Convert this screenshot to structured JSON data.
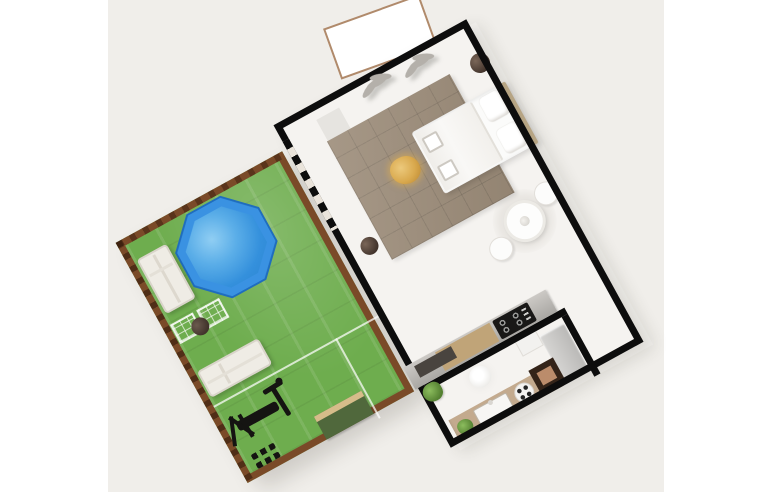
{
  "palette": {
    "background_scene": "#f0eeea",
    "floor": "#f5f3f0",
    "wall": "#0d0d0d",
    "grass": "#6ead4e",
    "fence": "#7a4a28",
    "pool_rim": "#3a92e2",
    "pool_water": "#3490dc",
    "rug": "#9c8c79",
    "bed_white": "#fbfbfa",
    "headboard": "#c6b28f",
    "lounger": "#efece5",
    "terrace_border": "#b08a6b",
    "counter_wood": "#c0a478",
    "cooktop": "#191817",
    "sink_counter": "#c3aa8e",
    "cabinet_dark": "#342419",
    "cabinet_board": "#bb8c6b",
    "fridge": "#bab9b7",
    "pot": "#41332b",
    "plant": "#548031",
    "decor_gray": "#b4b0aa",
    "gym_black": "#151412",
    "garden_bed_green": "#50683c",
    "garden_bed_trim": "#d6bc8a"
  },
  "scene": {
    "view": "top-down floor plan render, rotated about -29 degrees",
    "garden": {
      "items": [
        "octagonal-pool",
        "sun-lounger",
        "sun-lounger",
        "planter-rack",
        "planter-rack",
        "round-pot",
        "garden-bed",
        "gym-machine",
        "dumbbell-rack",
        "white-divider-lines",
        "wood-fence-border"
      ]
    },
    "main_room": {
      "items": [
        "double-bed-with-pillows",
        "tiled-area-rug",
        "golden-pouf",
        "round-dining-table",
        "chair",
        "chair",
        "kitchen-counter-with-cooktop",
        "plant-pot",
        "plant-pot",
        "wall-plant-decor",
        "wall-plant-decor",
        "wall-mat",
        "sliding-glass-door"
      ]
    },
    "kitchen_nook": {
      "items": [
        "sink-counter",
        "sink",
        "portable-hob",
        "dark-cabinet",
        "fridge",
        "white-cabinet",
        "pendant-lamp",
        "green-plant",
        "green-plant"
      ]
    },
    "terrace": {
      "items": [
        "white-terrace-pad"
      ]
    }
  }
}
